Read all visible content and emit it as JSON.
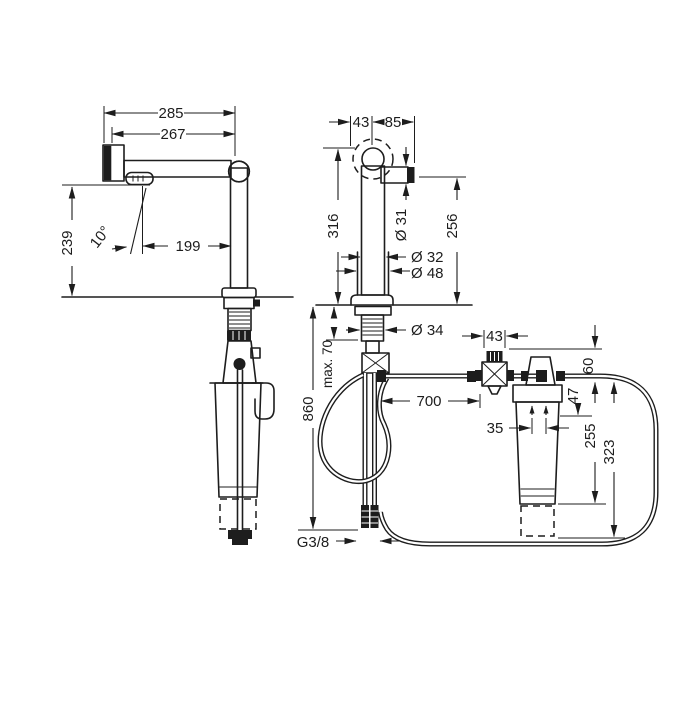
{
  "drawing_title": "faucet-filter-installation-dimensions",
  "dims": {
    "side": {
      "total_width": "285",
      "spout_width": "267",
      "spout_height": "239",
      "spray_angle": "10°",
      "spray_reach": "199"
    },
    "front": {
      "swivel_offset": "43",
      "spout_projection": "85",
      "spout_diameter": "Ø 31",
      "body_height": "316",
      "outlet_height": "256",
      "body_diameter": "Ø 32",
      "base_diameter": "Ø 48",
      "shank_diameter": "Ø 34",
      "max_counter": "max. 70",
      "hose_length": "860",
      "hose_run": "700",
      "thread": "G3/8"
    },
    "filter": {
      "valve_width": "43",
      "head_clearance": "60",
      "cap_offset": "47",
      "port_spacing": "35",
      "cartridge_height": "255",
      "total_height": "323"
    }
  }
}
